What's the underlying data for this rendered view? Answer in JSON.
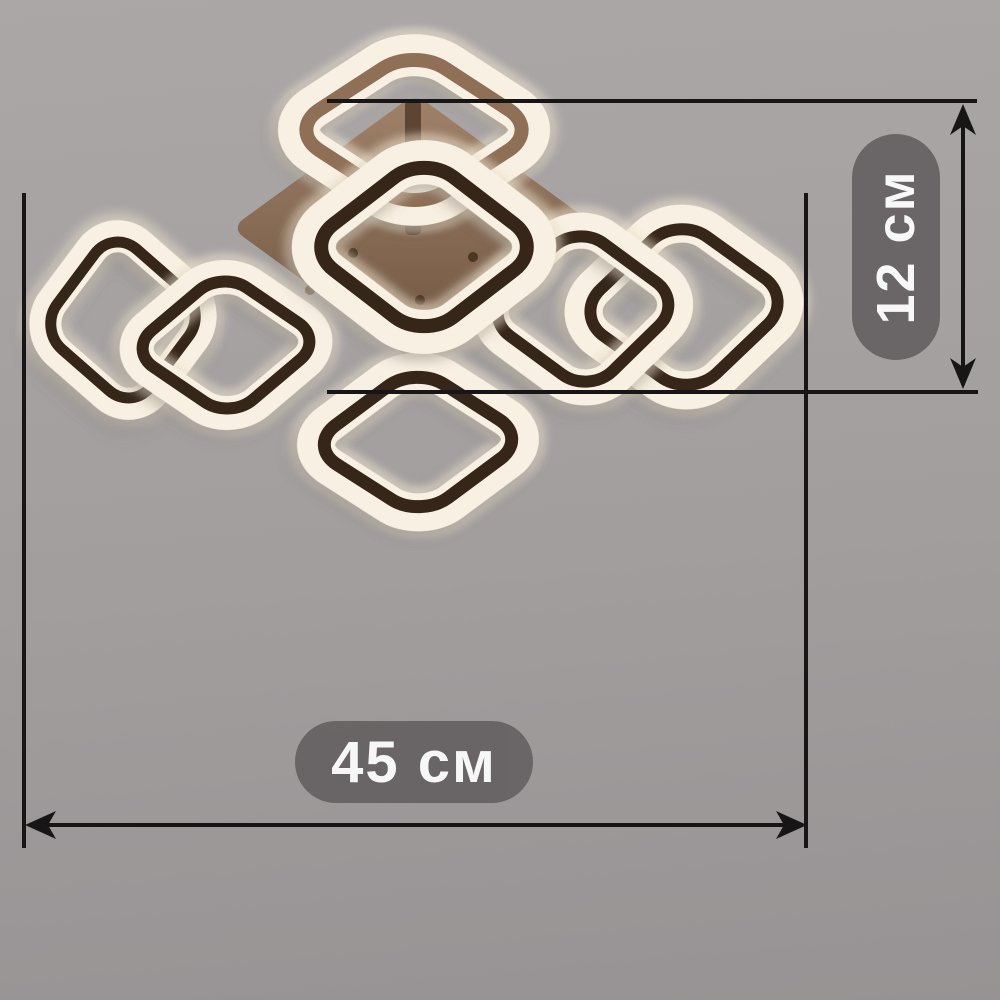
{
  "figure": {
    "subject": "ceiling-led-chandelier-with-square-rings"
  },
  "annotations": {
    "width_label": "45 см",
    "height_label": "12 см"
  },
  "colors": {
    "background_top": "#aba7a7",
    "background_bottom": "#979394",
    "dimension_line": "#171515",
    "label_pill_bg": "#666263",
    "label_text": "#ffffff",
    "ring_glow": "#f3e8d4",
    "ring_white": "#f8f0e2",
    "ring_frame": "#36261a",
    "ring_frame_light": "#8f6f56",
    "plate_top": "#a08269",
    "plate_bottom": "#6d533f",
    "metal": "#5d4534"
  }
}
